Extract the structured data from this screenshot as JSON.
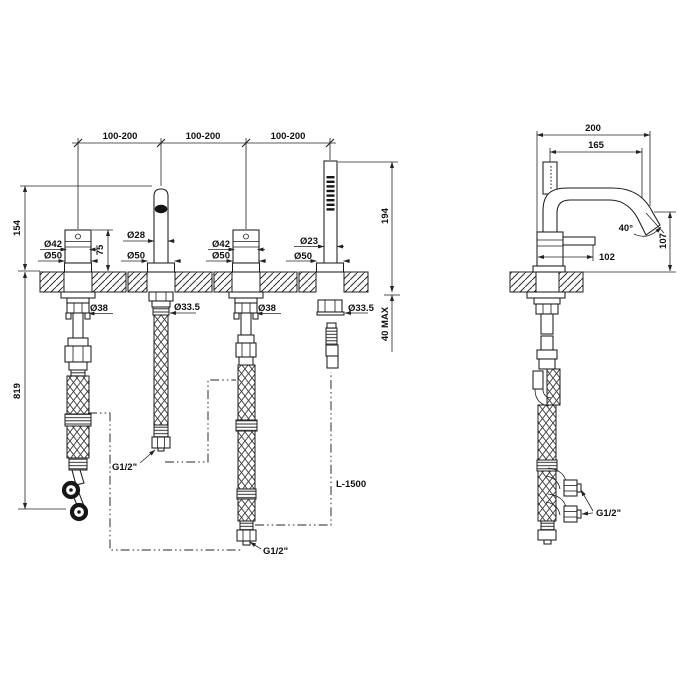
{
  "drawing": {
    "front_view": {
      "spacing": [
        "100-200",
        "100-200",
        "100-200"
      ],
      "spout_height": "154",
      "handle_height": "75",
      "hose_drop": "819",
      "wand_height": "194",
      "deck_thickness_max": "40 MAX",
      "handle_left": {
        "diameter": "Ø42",
        "base": "Ø50",
        "shank": "Ø38"
      },
      "spout": {
        "diameter": "Ø28",
        "base": "Ø50",
        "shank": "Ø33.5",
        "connection": "G1/2\""
      },
      "handle_right": {
        "diameter": "Ø42",
        "base": "Ø50",
        "shank": "Ø38",
        "connection": "G1/2\""
      },
      "handshower": {
        "diameter": "Ø23",
        "base": "Ø50",
        "shank": "Ø33.5",
        "hose_length": "L-1500"
      }
    },
    "side_view": {
      "reach_total": "200",
      "reach_spout": "165",
      "outlet_angle": "40°",
      "spout_height": "107",
      "body_length": "102",
      "connection": "G1/2\""
    }
  }
}
